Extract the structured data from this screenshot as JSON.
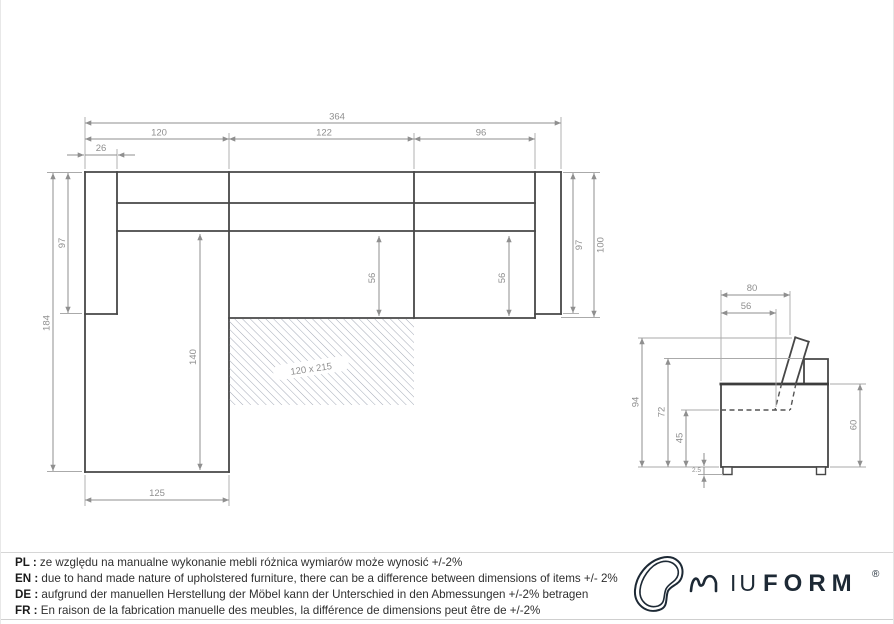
{
  "top_view": {
    "total_width": "364",
    "section_left": "120",
    "section_mid": "122",
    "section_right": "96",
    "armrest_width": "26",
    "left_arm_depth": "97",
    "total_depth": "184",
    "chaise_inner_length": "140",
    "mid_seat_depth": "56",
    "right_seat_depth": "56",
    "right_arm_depth": "97",
    "right_total_depth": "100",
    "chaise_width": "125",
    "bed_area": "120 x 215"
  },
  "side_view": {
    "depth_total": "80",
    "seat_depth": "56",
    "height_total": "94",
    "height_back": "72",
    "height_seat": "45",
    "height_leg": "2.5",
    "height_arm": "60"
  },
  "footer": {
    "notes": [
      {
        "label": "PL :",
        "text": "ze względu na manualne wykonanie mebli różnica wymiarów może wynosić +/-2%"
      },
      {
        "label": "EN :",
        "text": "due to hand made nature of upholstered furniture, there can be a difference between dimensions of items +/- 2%"
      },
      {
        "label": "DE :",
        "text": "aufgrund der manuellen Herstellung der Möbel kann der Unterschied in den Abmessungen +/-2% betragen"
      },
      {
        "label": "FR :",
        "text": "En raison de la fabrication manuelle des meubles, la différence de dimensions peut être de +/-2%"
      }
    ]
  },
  "logo": {
    "brand_light": "IU",
    "brand_bold": "FORM",
    "registered": "®"
  },
  "colors": {
    "outline": "#474747",
    "dimension": "#8f8f8f",
    "note_text": "#2f2f2f",
    "logo": "#1d2935",
    "hatch": "#9aa0af"
  }
}
